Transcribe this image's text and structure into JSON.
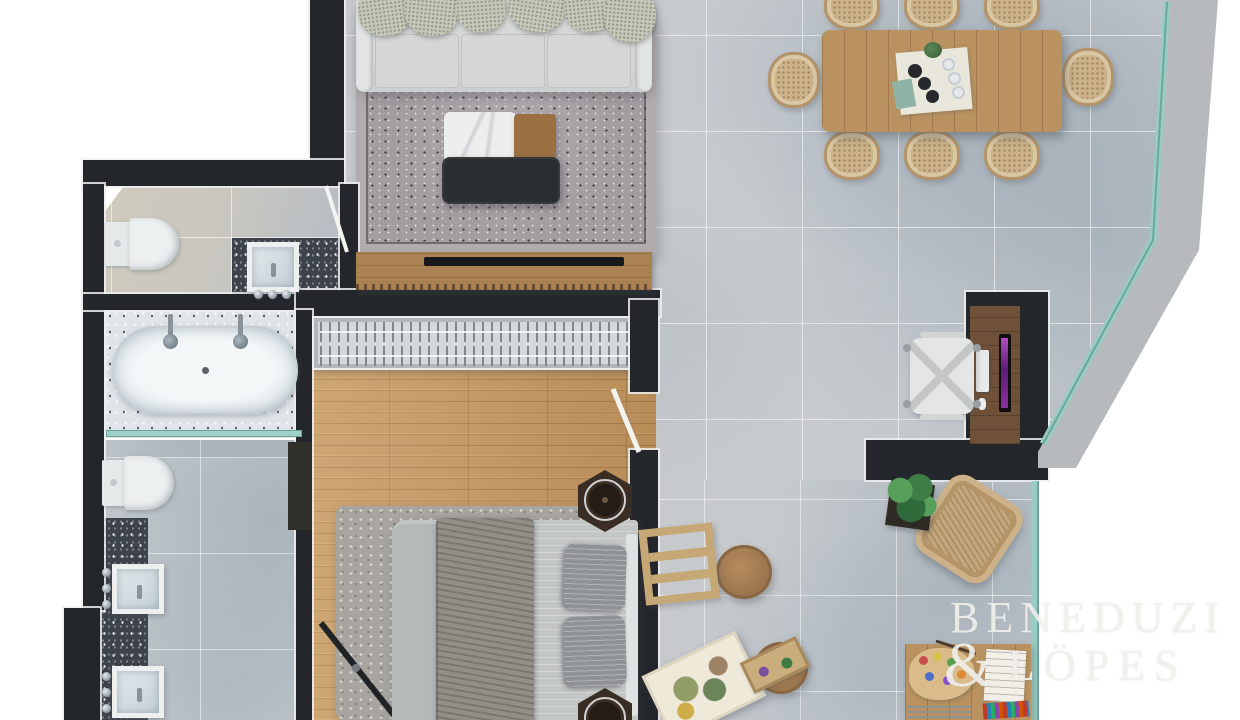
{
  "watermark": {
    "line1": "BENEDUZI",
    "ampersand": "&",
    "line2": "LÖPES"
  },
  "palette": {
    "background": "#ffffff",
    "wall": "#23262a",
    "tile_floor": "#c7cbce",
    "wood_floor": "#c2955f",
    "glass_wall": "#97cdc3",
    "concrete_ledge": "#b6babc",
    "dark_counter": "#3e434b",
    "living_rug": "#a39da0",
    "sofa": "#d7dad8",
    "dining_wood": "#b9925f",
    "monitor_screen": "#8a2f9e",
    "bathtub": "#f4f7f8"
  },
  "furniture": [
    "sofa",
    "living-rug",
    "coffee-table",
    "ottoman",
    "tv-console",
    "tv",
    "dining-table",
    "dining-chairs",
    "table-setting",
    "desk",
    "office-chair",
    "monitor",
    "keyboard",
    "mouse",
    "bed",
    "bed-pillows",
    "bed-rug",
    "nightstands",
    "closet-hangers",
    "floor-mirror",
    "toilet",
    "bathtub",
    "vanity-sinks",
    "glass-partition",
    "armchair",
    "stools",
    "easel",
    "painting-canvas",
    "art-table",
    "paint-palette",
    "colored-pencils",
    "potted-plant"
  ]
}
